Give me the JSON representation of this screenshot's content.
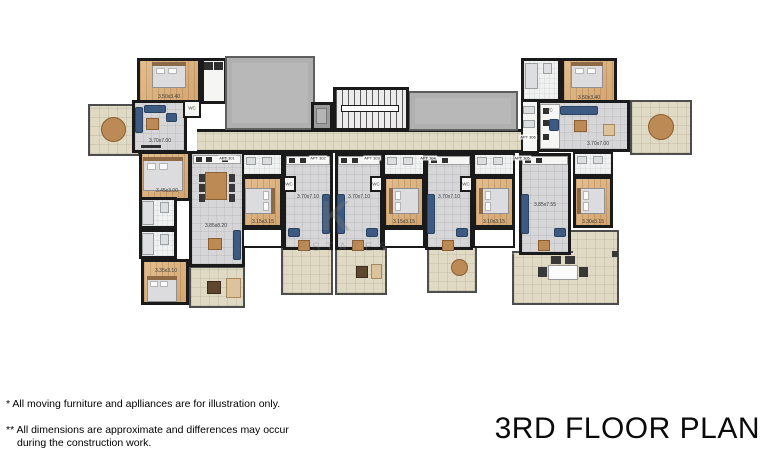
{
  "title": "3RD FLOOR PLAN",
  "notes": {
    "line1": "* All moving furniture and aplliances are for illustration only.",
    "line2": "** All dimensions are approximate and differences may occur",
    "line3": "during the construction work."
  },
  "watermark": {
    "letter": "K",
    "text": "ESTATES"
  },
  "colors": {
    "wall": "#1a1a1a",
    "wood_floor": "#d9ae7d",
    "gray_tile": "#d6d6d8",
    "terrace_tile": "#e0dac5",
    "roof": "#b8b8b8",
    "sofa_navy": "#3c5a82",
    "furniture_brown": "#bb8a55"
  },
  "plan": {
    "wc_text": "WC",
    "dim_labels": [
      {
        "text": "3.50x3.40",
        "x": 169,
        "y": 97
      },
      {
        "text": "3.70x7.00",
        "x": 160,
        "y": 141
      },
      {
        "text": "3.45x3.00",
        "x": 167,
        "y": 191
      },
      {
        "text": "3.85x8.20",
        "x": 216,
        "y": 226
      },
      {
        "text": "3.35x3.10",
        "x": 166,
        "y": 271
      },
      {
        "text": "3.15x3.15",
        "x": 263,
        "y": 222
      },
      {
        "text": "3.70x7.10",
        "x": 308,
        "y": 197
      },
      {
        "text": "3.70x7.10",
        "x": 359,
        "y": 197
      },
      {
        "text": "3.15x3.15",
        "x": 404,
        "y": 222
      },
      {
        "text": "3.70x7.10",
        "x": 449,
        "y": 197
      },
      {
        "text": "3.10x3.15",
        "x": 494,
        "y": 222
      },
      {
        "text": "3.85x7.55",
        "x": 545,
        "y": 205
      },
      {
        "text": "3.30x3.15",
        "x": 593,
        "y": 222
      },
      {
        "text": "3.50x3.40",
        "x": 589,
        "y": 98
      },
      {
        "text": "3.70x7.00",
        "x": 598,
        "y": 144
      }
    ],
    "apt_labels": [
      {
        "text": "APT 301",
        "x": 227,
        "y": 158
      },
      {
        "text": "APT 302",
        "x": 318,
        "y": 158
      },
      {
        "text": "APT 303",
        "x": 372,
        "y": 158
      },
      {
        "text": "APT 304",
        "x": 428,
        "y": 158
      },
      {
        "text": "APT 305",
        "x": 522,
        "y": 158
      },
      {
        "text": "APT 306",
        "x": 528,
        "y": 137
      }
    ],
    "wc_labels": [
      {
        "x": 192,
        "y": 108
      },
      {
        "x": 289,
        "y": 184
      },
      {
        "x": 376,
        "y": 184
      },
      {
        "x": 466,
        "y": 184
      },
      {
        "x": 549,
        "y": 110
      }
    ]
  }
}
